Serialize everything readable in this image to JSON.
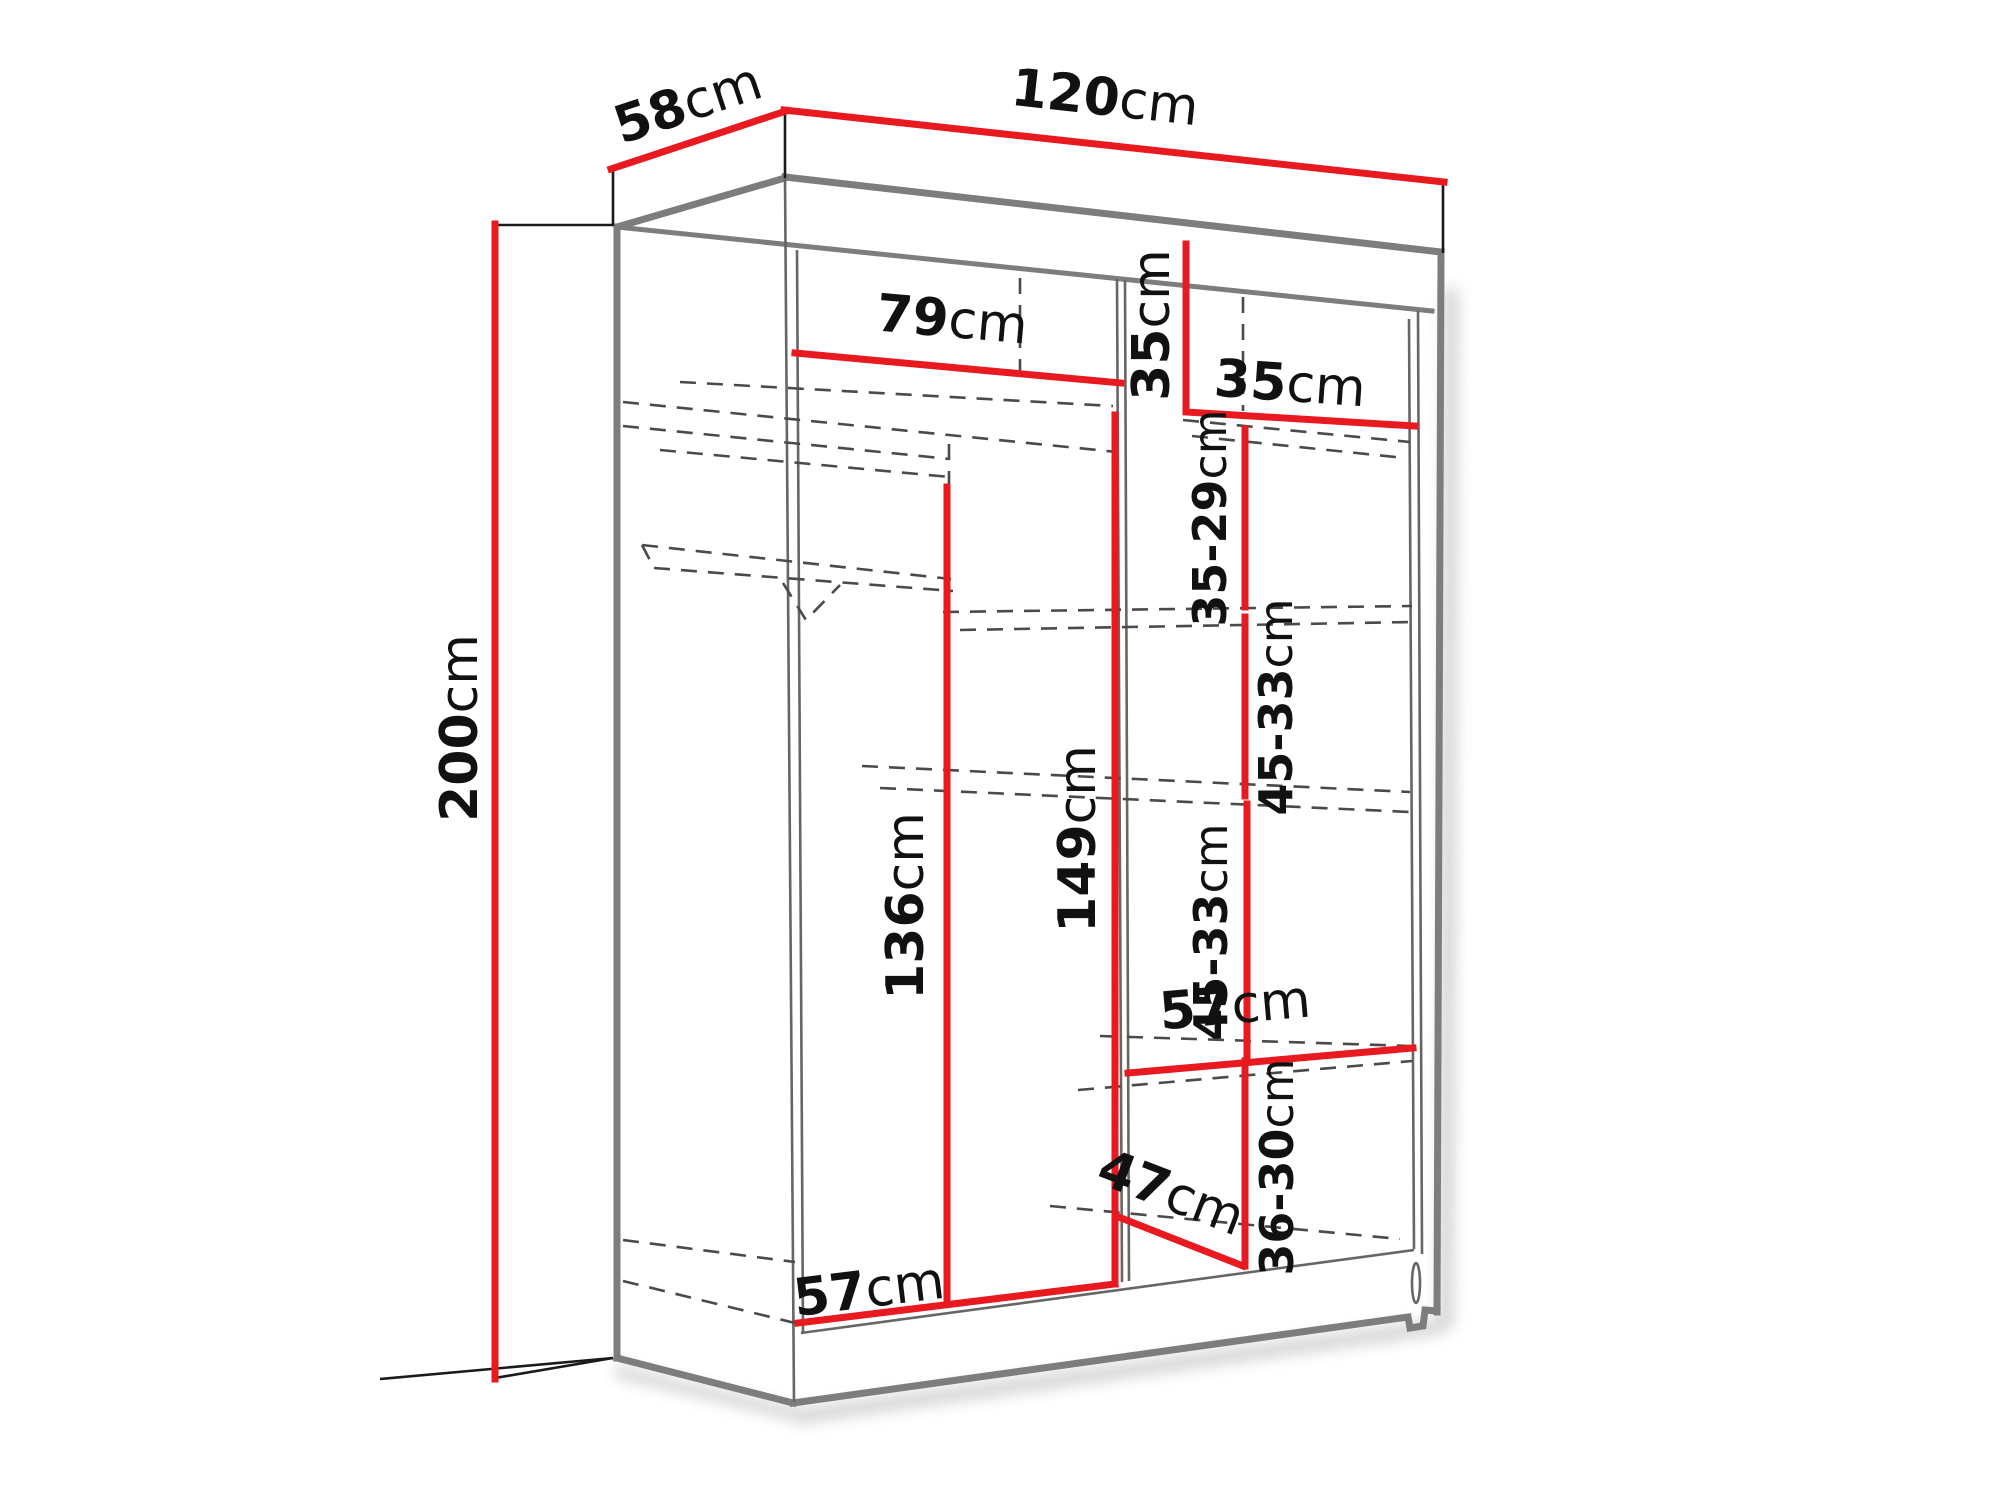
{
  "colors": {
    "dimension_red": "#e8191f",
    "structure_gray": "#7d7d7d",
    "thin_gray": "#666666",
    "dash_gray": "#4a4a4a",
    "line_dark": "#1a1a1a",
    "shadow": "#c9c9c9",
    "background": "#ffffff"
  },
  "dims": {
    "depth": {
      "value": "58",
      "unit": "cm"
    },
    "width": {
      "value": "120",
      "unit": "cm"
    },
    "height": {
      "value": "200",
      "unit": "cm"
    },
    "left_top_width": {
      "value": "79",
      "unit": "cm"
    },
    "right_cubby_height             ": {
      "value": "35",
      "unit": "cm"
    },
    "right_cubby_height": {
      "value": "35",
      "unit": "cm"
    },
    "right_col_width": {
      "value": "35",
      "unit": "cm"
    },
    "left_hang_height": {
      "value": "136",
      "unit": "cm"
    },
    "right_col_height": {
      "value": "149",
      "unit": "cm"
    },
    "gap1": {
      "value": "35-29",
      "unit": "cm"
    },
    "gap2": {
      "value": "45-33",
      "unit": "cm"
    },
    "gap3": {
      "value": "45-33",
      "unit": "cm"
    },
    "shelf57": {
      "value": "57",
      "unit": "cm"
    },
    "gap4": {
      "value": "36-30",
      "unit": "cm"
    },
    "diag47": {
      "value": "47",
      "unit": "cm"
    },
    "bottom57": {
      "value": "57",
      "unit": "cm"
    }
  }
}
